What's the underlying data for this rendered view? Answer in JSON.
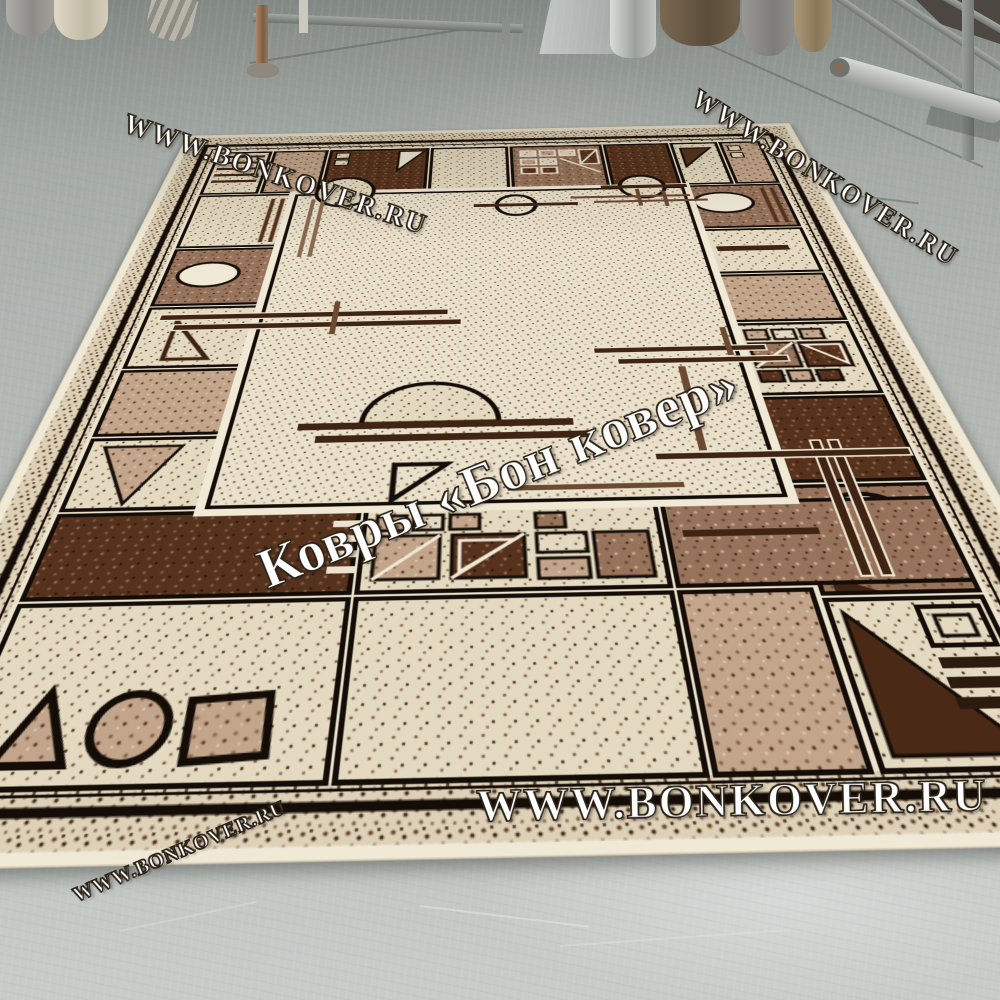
{
  "watermarks": {
    "top_left": "WWW.BONKOVER.RU",
    "top_right": "WWW.BONKOVER.RU",
    "center": "Ковры «Бон ковер»",
    "bottom": "WWW.BONKOVER.RU",
    "bottom_left": "WWW.BONKOVER.RU"
  },
  "palette": {
    "floor_near": "#c2c7c4",
    "floor_far": "#8e948f",
    "carpet_cream": "#e9e1cc",
    "carpet_beige_band": "#ddd1b8",
    "carpet_tan": "#c2a58b",
    "carpet_brown": "#97735c",
    "carpet_dark_brown": "#56321d",
    "carpet_outline": "#140d07",
    "watermark_color": "#ffffff"
  }
}
